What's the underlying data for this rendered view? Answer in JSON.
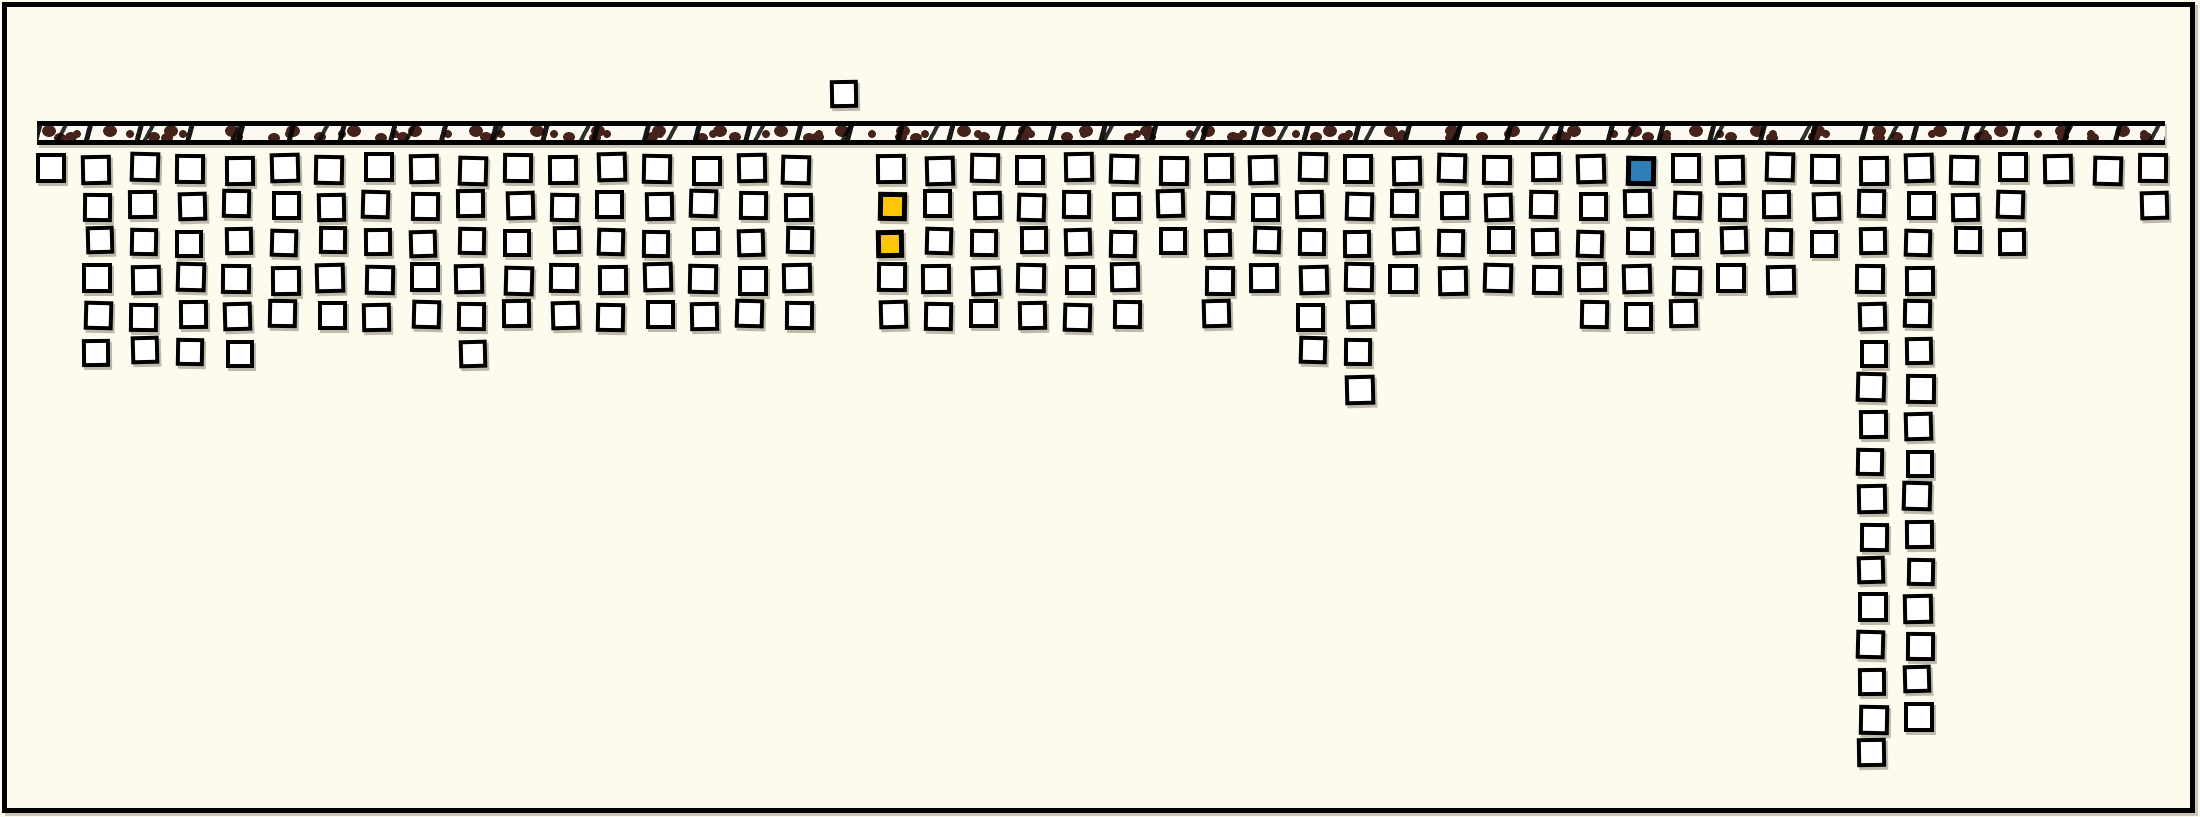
{
  "figure": {
    "kind": "xkcd-style comic panel, no visible text",
    "colors": {
      "background": "#FDFBEE",
      "frame": "#000000",
      "square_fill": "#FFFFFF",
      "square_border": "#000000",
      "yellow": "#FDC609",
      "blue": "#2E7EB8",
      "soil_brown": "#46231A",
      "bar_base": "#FBF9F2"
    }
  },
  "chart_data": {
    "type": "pictograph",
    "title": "",
    "xlabel": "",
    "ylabel": "",
    "description": "A horizontal ground-surface bar (white band textured with dark-brown soil blobs and slanted black hatch marks, bordered in black) spans the panel just below the top. 46 evenly spaced column positions hang below the bar, each a contiguous stack of hand-drawn outlined unit squares starting at the first row under the bar. Position 17 has no below-ground squares; instead a single square floats above the bar at that position. Two squares are highlighted yellow (column 18, rows 2-3) and one square is highlighted blue (column 34, row 1). Columns 39 and 40 are extremely deep (17 and 16 squares).",
    "legend": "none",
    "grid": "off",
    "categories_note": "columns are unlabeled positions 0-45, left to right",
    "columns": [
      1,
      6,
      6,
      6,
      6,
      5,
      5,
      5,
      5,
      6,
      5,
      5,
      5,
      5,
      5,
      5,
      5,
      0,
      5,
      5,
      5,
      5,
      5,
      5,
      3,
      5,
      4,
      6,
      7,
      4,
      4,
      4,
      4,
      5,
      5,
      5,
      4,
      4,
      3,
      17,
      16,
      3,
      3,
      1,
      1,
      2
    ],
    "above_ground_square": {
      "column_index": 17,
      "count": 1
    },
    "highlights": [
      {
        "column_index": 18,
        "rows": [
          2,
          3
        ],
        "color_name": "yellow"
      },
      {
        "column_index": 34,
        "rows": [
          1
        ],
        "color_name": "blue"
      }
    ],
    "total_squares": 227
  }
}
